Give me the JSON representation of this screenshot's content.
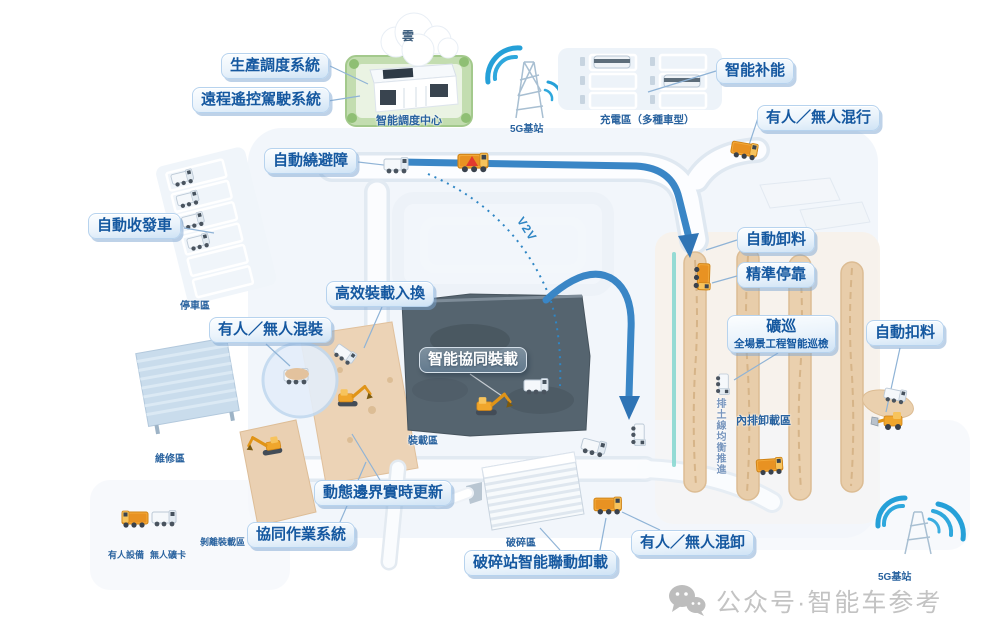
{
  "callouts": {
    "production_scheduling": "生產調度系統",
    "remote_driving": "遠程遙控駕駛系統",
    "smart_recharging": "智能补能",
    "mixed_driving": "有人／無人混行",
    "auto_obstacle_avoidance": "自動繞避障",
    "auto_dispatch_return": "自動收發車",
    "efficient_loading_rotation": "高效裝載入換",
    "mixed_loading": "有人／無人混裝",
    "smart_collaborative_loading": "智能協同裝載",
    "auto_unloading": "自動卸料",
    "precise_docking": "精準停靠",
    "mine_patrol": "礦巡",
    "mine_patrol_subtitle": "全場景工程智能巡檢",
    "auto_material_cutoff": "自動扣料",
    "dynamic_boundary_update": "動態邊界實時更新",
    "collaborative_operation_system": "協同作業系統",
    "crusher_station_linked_unloading": "破碎站智能聯動卸載",
    "mixed_unloading": "有人／無人混卸"
  },
  "zones": {
    "cloud": "雲",
    "dispatch_center": "智能調度中心",
    "g5_station_left": "5G基站",
    "g5_station_right": "5G基站",
    "charging_area": "充電區（多種車型）",
    "parking_area": "停車區",
    "maintenance_area": "維修區",
    "loading_area": "裝載區",
    "crushing_area": "破碎區",
    "stripping_loading_area": "剝離裝載區",
    "inner_dump_area": "內排卸載區",
    "dump_line_note": "排土線均衡推進",
    "manned_equipment": "有人設備",
    "unmanned_truck": "無人礦卡",
    "v2v_link": "V2V"
  },
  "watermark": {
    "text": "公众号·智能车参考"
  },
  "colors": {
    "accent_blue": "#2f86c5",
    "callout_text_blue": "#1558a0",
    "route_blue": "#3a86c6",
    "vehicle_orange": "#f3a93a",
    "sand_tan": "#ead0ae",
    "pit_slate": "#55646f",
    "watermark_gray": "#c3c3c3"
  }
}
